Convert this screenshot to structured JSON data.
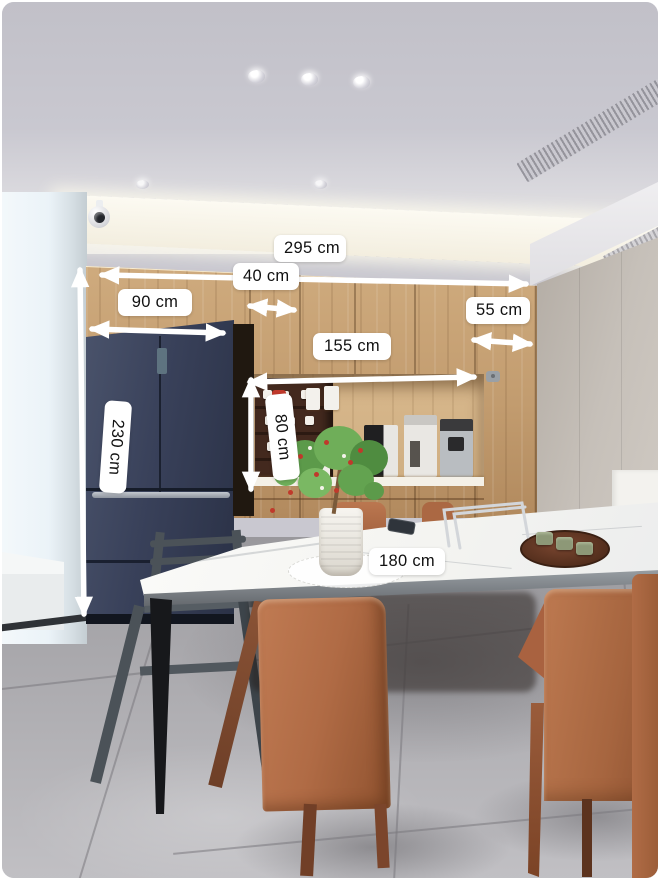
{
  "image": {
    "type": "annotated-interior-photo",
    "subject": "Kitchen dining area with wood cabinetry, fridge, coffee niche and dining table, overlaid with dimension measurements"
  },
  "annotations": {
    "cabinet_total_width": {
      "text": "295 cm",
      "orientation": "horizontal"
    },
    "panel_width": {
      "text": "40 cm",
      "orientation": "horizontal"
    },
    "fridge_width": {
      "text": "90 cm",
      "orientation": "horizontal"
    },
    "side_panel_width": {
      "text": "55 cm",
      "orientation": "horizontal"
    },
    "niche_width": {
      "text": "155 cm",
      "orientation": "horizontal"
    },
    "fridge_height": {
      "text": "230 cm",
      "orientation": "vertical"
    },
    "niche_height": {
      "text": "80 cm",
      "orientation": "vertical"
    },
    "table_length": {
      "text": "180 cm",
      "orientation": "horizontal"
    }
  },
  "colors": {
    "arrow": "#ffffff",
    "label_bg": "#ffffff",
    "label_text": "#111111",
    "ceiling": "#c9c8d0",
    "wood": "#cfab7e",
    "niche_back": "#d8b88c",
    "shelf_dark": "#43291e",
    "fridge": "#39415a",
    "right_wall": "#b3aca4",
    "table": "#f4f4f1",
    "chair": "#b06b45",
    "wood_leg": "#713f27",
    "high_chair": "#4b5258",
    "floor": "#a7a6aa",
    "plant_green": "#5f9e4e",
    "plant_red": "#c0392b",
    "tray": "#5c3320"
  }
}
